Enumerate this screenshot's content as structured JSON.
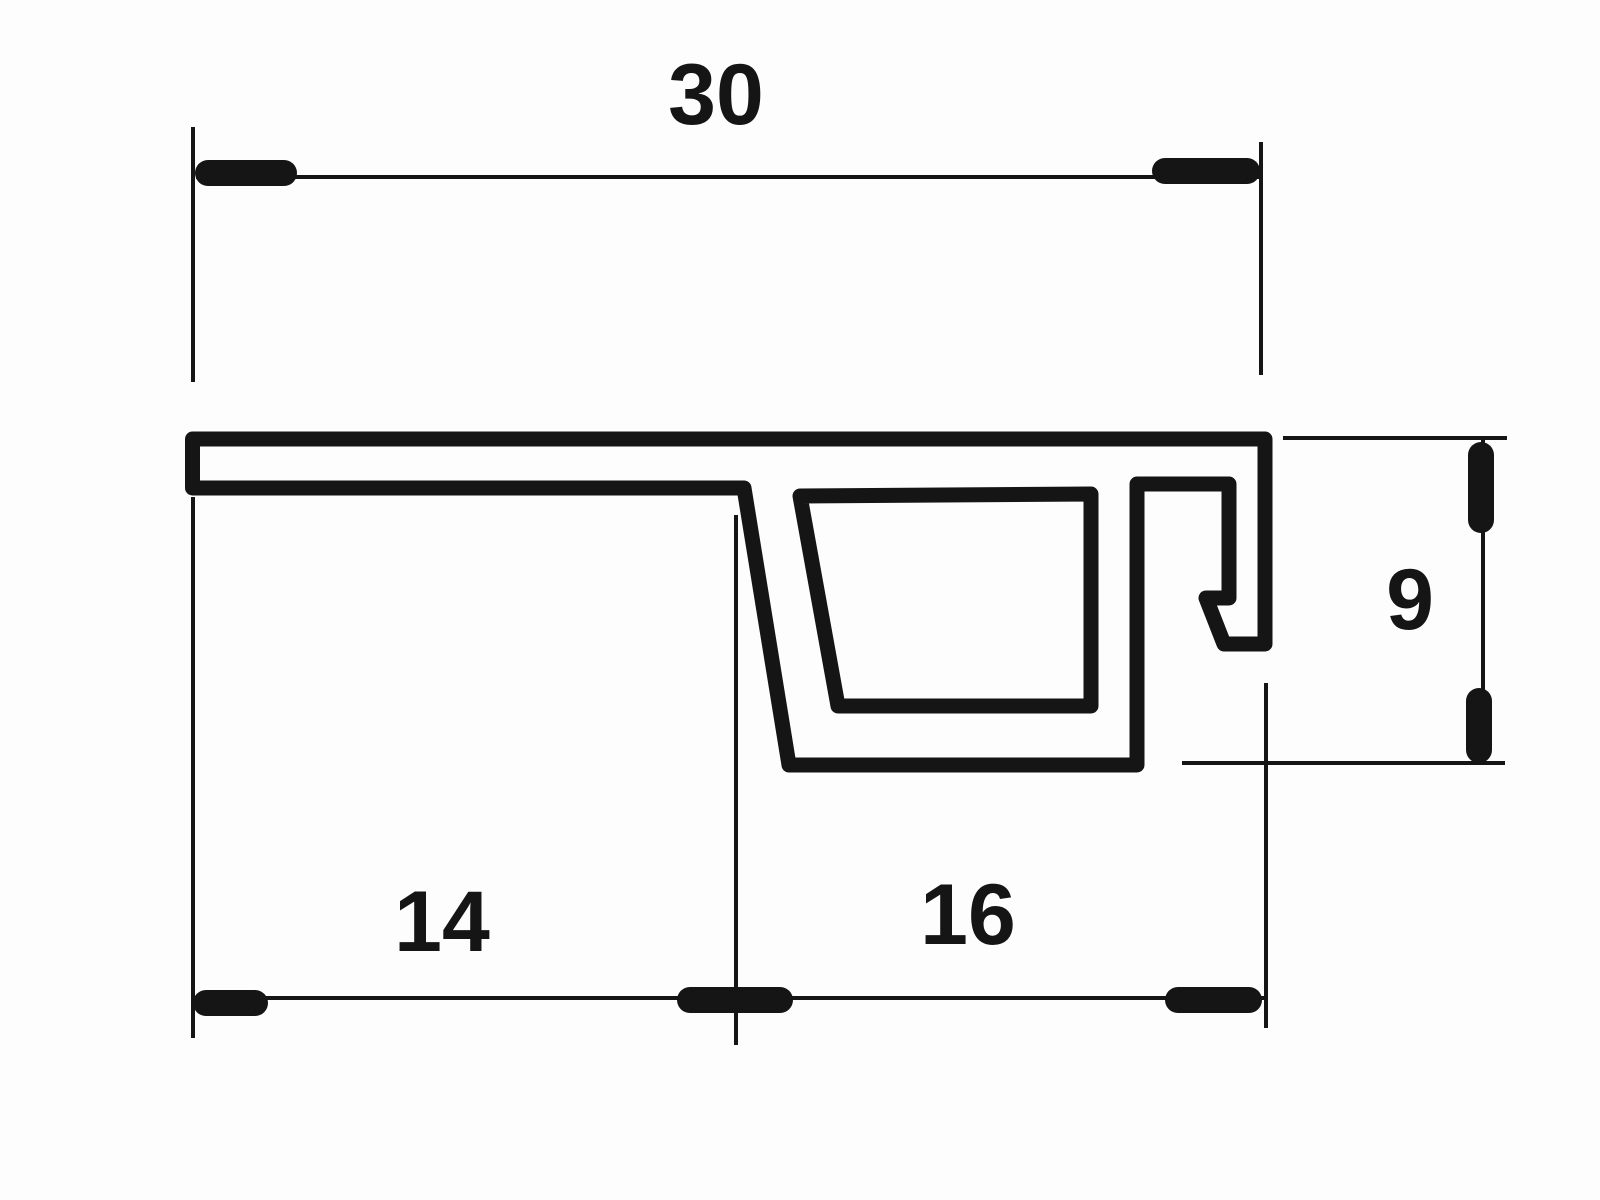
{
  "drawing": {
    "title": "profile-cross-section-technical-drawing",
    "background_color": "#fdfdfd",
    "line_color": "#151515",
    "profile_stroke_px": 15,
    "dim_line_stroke_px": 4,
    "tick_stroke_px": 26,
    "label_font_px": 86,
    "dimensions": {
      "top_width": {
        "value": "30"
      },
      "bottom_left_width": {
        "value": "14"
      },
      "bottom_right_width": {
        "value": "16"
      },
      "right_height": {
        "value": "9"
      }
    }
  }
}
